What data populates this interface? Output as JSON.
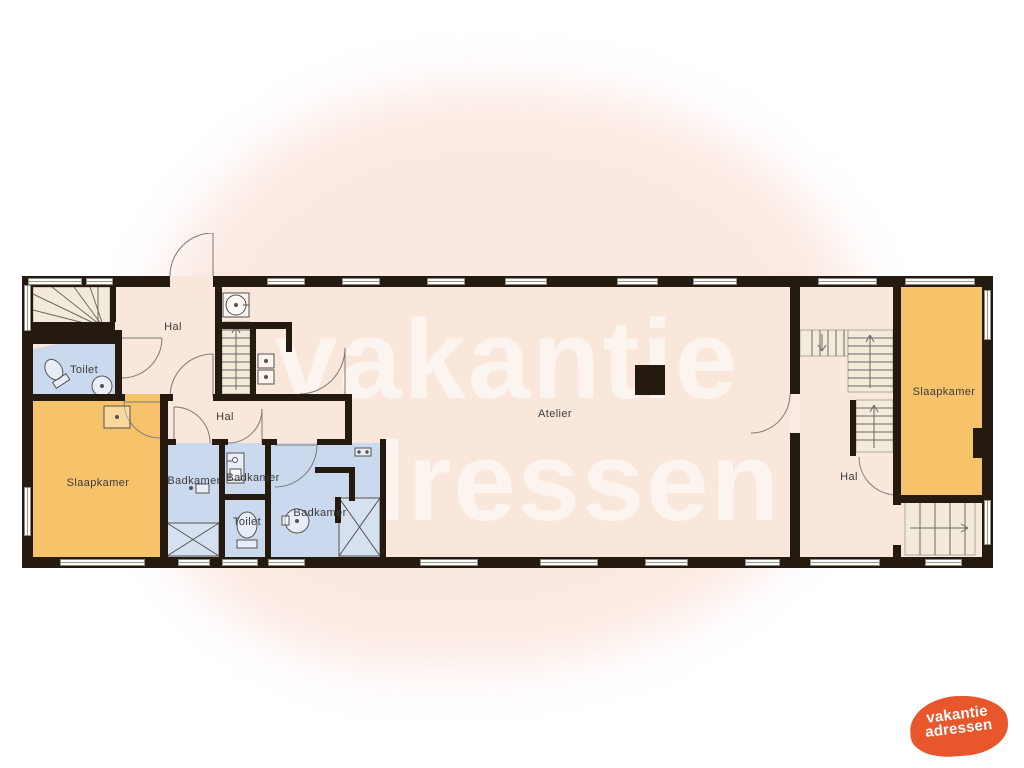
{
  "watermark": {
    "line1": "vakantie",
    "line2": "adressen"
  },
  "logo": {
    "line1": "vakantie",
    "line2": "adressen",
    "background_color": "#e8562b",
    "text_color": "#ffffff"
  },
  "palette": {
    "floor": "#f8e7da",
    "wall": "#241a10",
    "bedroom": "#f6c36a",
    "bathroom": "#cbd9ee",
    "background_blob": "#fae4db",
    "label_text": "#3c3c3c",
    "line": "#6a6a6a"
  },
  "rooms": [
    {
      "id": "hal-top-left",
      "label": "Hal"
    },
    {
      "id": "toilet-left",
      "label": "Toilet"
    },
    {
      "id": "slaapkamer-left",
      "label": "Slaapkamer"
    },
    {
      "id": "hal-middle",
      "label": "Hal"
    },
    {
      "id": "badkamer-left",
      "label": "Badkamer"
    },
    {
      "id": "badkamer-middle",
      "label": "Badkamer"
    },
    {
      "id": "toilet-middle",
      "label": "Toilet"
    },
    {
      "id": "badkamer-right",
      "label": "Badkamer"
    },
    {
      "id": "atelier",
      "label": "Atelier"
    },
    {
      "id": "hal-right",
      "label": "Hal"
    },
    {
      "id": "slaapkamer-right",
      "label": "Slaapkamer"
    }
  ],
  "icons": {
    "stairs": "stair treads with direction arrow",
    "door": "quarter-circle swing arc",
    "sink": "square or circle basin with drain dot",
    "toilet": "bowl ellipse with cistern",
    "shower": "rectangle with X diagonals",
    "washer": "stacked appliance squares",
    "column": "solid black square"
  }
}
